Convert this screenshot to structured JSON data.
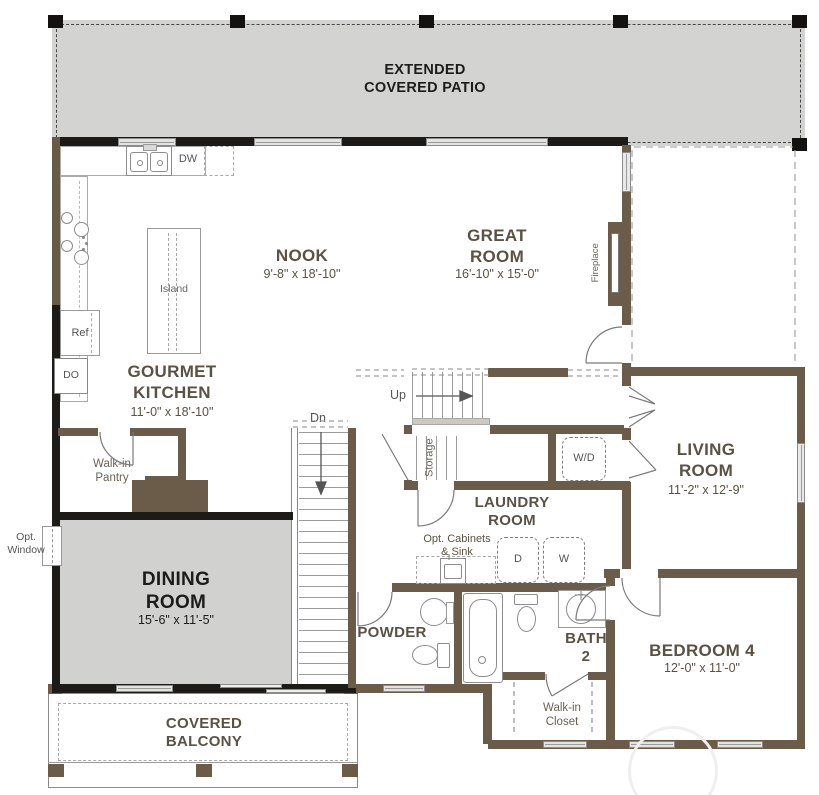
{
  "colors": {
    "wall_dark": "#1d1b18",
    "wall_brown": "#6a5c49",
    "floor_gray": "#d3d3d2",
    "label_brown": "#5a5244",
    "label_black": "#1c1c1c"
  },
  "rooms": {
    "patio": {
      "name": "EXTENDED\nCOVERED PATIO"
    },
    "nook": {
      "name": "NOOK",
      "dims": "9'-8\" x 18'-10\""
    },
    "great": {
      "name": "GREAT\nROOM",
      "dims": "16'-10\" x 15'-0\""
    },
    "kitchen": {
      "name": "GOURMET\nKITCHEN",
      "dims": "11'-0\" x 18'-10\""
    },
    "living": {
      "name": "LIVING\nROOM",
      "dims": "11'-2\" x 12'-9\""
    },
    "dining": {
      "name": "DINING\nROOM",
      "dims": "15'-6\" x 11'-5\""
    },
    "bedroom4": {
      "name": "BEDROOM 4",
      "dims": "12'-0\" x 11'-0\""
    },
    "laundry": {
      "name": "LAUNDRY\nROOM"
    },
    "powder": {
      "name": "POWDER"
    },
    "bath2": {
      "name": "BATH\n2"
    },
    "balcony": {
      "name": "COVERED\nBALCONY"
    },
    "pantry": {
      "name": "Walk-in\nPantry"
    },
    "closet": {
      "name": "Walk-in\nCloset"
    },
    "storage": {
      "name": "Storage"
    }
  },
  "fixtures": {
    "island": "Island",
    "fridge": "Ref",
    "double_oven": "DO",
    "dishwasher": "DW",
    "washer_dryer": "W/D",
    "dryer": "D",
    "washer": "W",
    "fireplace": "Fireplace"
  },
  "stairs": {
    "up": "Up",
    "down": "Dn"
  },
  "options": {
    "window": "Opt.\nWindow",
    "cabinets_sink": "Opt. Cabinets\n& Sink"
  }
}
